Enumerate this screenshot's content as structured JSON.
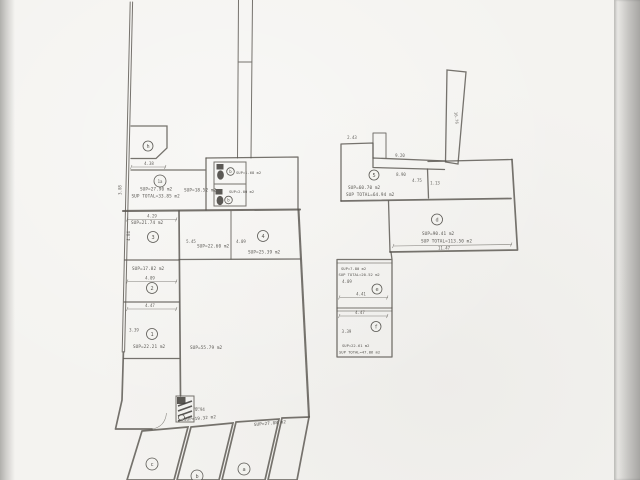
{
  "document_kind": "scanned architectural floor plan",
  "colors": {
    "paper": "#f4f3f0",
    "ink": "#59564f",
    "scan_edge": "#a7a6a3"
  },
  "rooms": [
    {
      "id": "h",
      "label": "h"
    },
    {
      "id": "1a",
      "label": "1a",
      "sup": "SUP=27.90 m2",
      "sup_total": "SUP TOTAL=33.85 m2"
    },
    {
      "id": "hall-top",
      "sup": "SUP=18.52 m2"
    },
    {
      "id": "bath-upper",
      "label": "b",
      "sup": "SUP=1.68 m2"
    },
    {
      "id": "bath-lower",
      "label": "b",
      "sup": "SUP=2.00 m2"
    },
    {
      "id": "3",
      "label": "3",
      "sup": "SUP=21.74 m2"
    },
    {
      "id": "2",
      "label": "2",
      "sup": "SUP=17.82 m2"
    },
    {
      "id": "1",
      "label": "1",
      "sup": "SUP=22.21 m2"
    },
    {
      "id": "store",
      "sup": "SUP=22.60 m2"
    },
    {
      "id": "4",
      "label": "4",
      "sup": "SUP=25.39 m2"
    },
    {
      "id": "hall-main",
      "sup": "SUP=55.79 m2"
    },
    {
      "id": "5",
      "label": "5",
      "sup": "SUP=60.70 m2",
      "sup_total": "SUP TOTAL=64.94 m2"
    },
    {
      "id": "d",
      "label": "d",
      "sup": "SUP=90.41 m2",
      "sup_total": "SUP TOTAL=113.50 m2"
    },
    {
      "id": "e",
      "label": "e",
      "sup": "SUP=7.80 m2",
      "sup_total": "SUP TOTAL=20.52 m2"
    },
    {
      "id": "f",
      "label": "f",
      "sup": "SUP=22.61 m2",
      "sup_total": "SUP TOTAL=47.86 m2"
    },
    {
      "id": "c",
      "label": "c"
    },
    {
      "id": "b2",
      "label": "b",
      "sup": "SUP=19.32 m2"
    },
    {
      "id": "a",
      "label": "a",
      "sup": "SUP=27.88 m2"
    }
  ],
  "dim_labels": [
    "4.38",
    "3.08",
    "4.29",
    "4.84",
    "4.09",
    "4.47",
    "3.39",
    "5.45",
    "4.09",
    "2.43",
    "9.20",
    "4.75",
    "1.13",
    "11.47",
    "4.09",
    "4.41",
    "4.47",
    "3.39",
    "8.90",
    "16.76",
    "0.94"
  ]
}
